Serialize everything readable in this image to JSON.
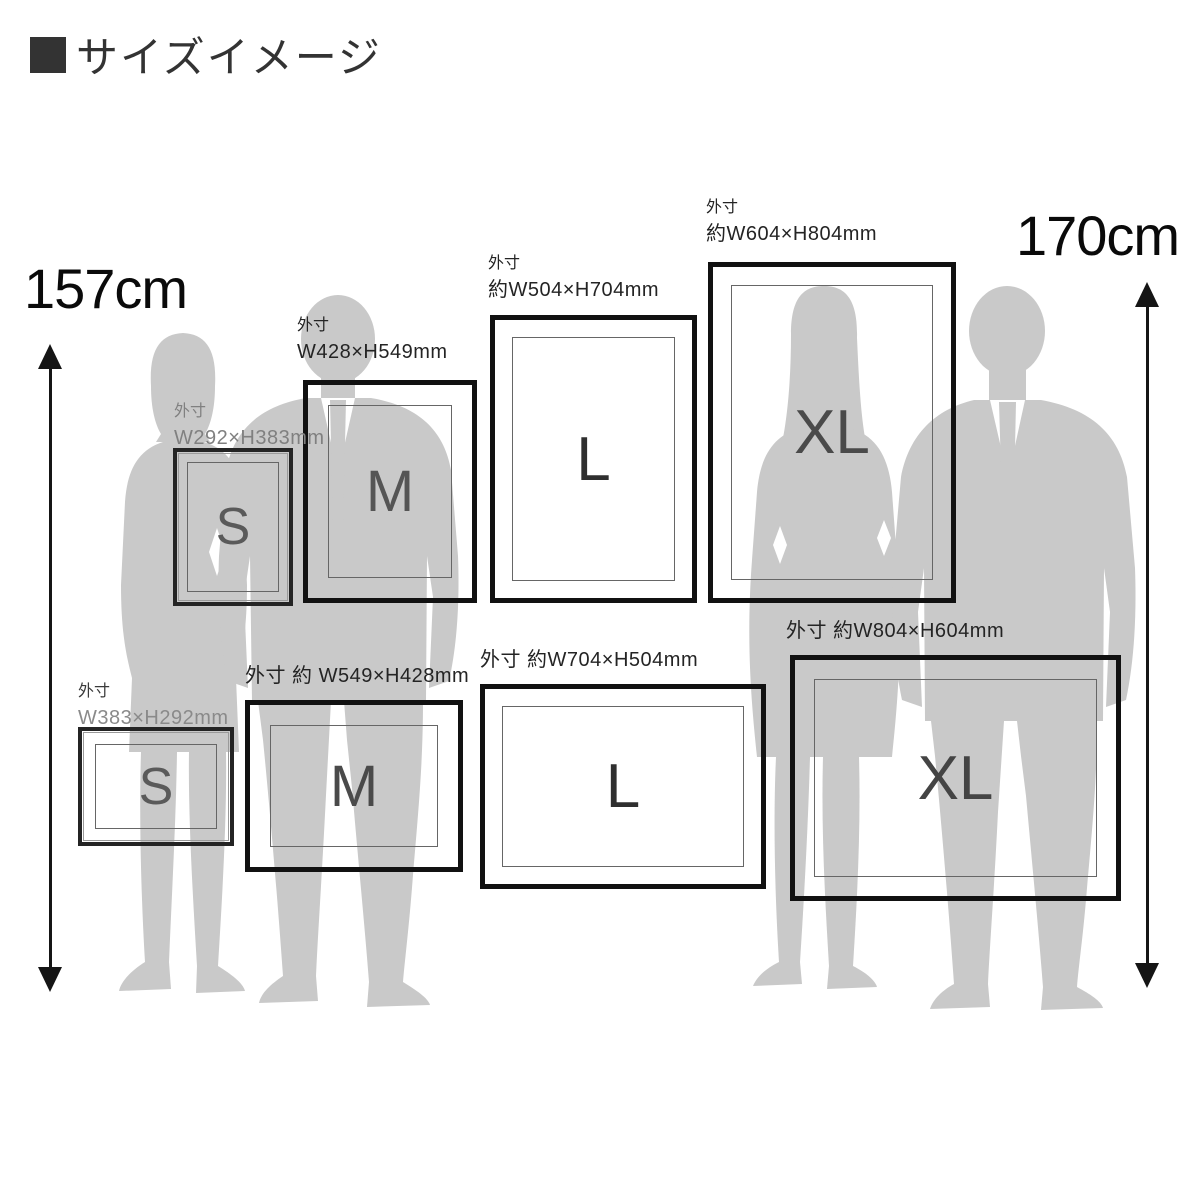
{
  "title": {
    "bullet": "■",
    "text": "サイズイメージ"
  },
  "measurements": {
    "left_height": "157cm",
    "right_height": "170cm"
  },
  "frames": {
    "portrait": [
      {
        "size": "S",
        "l1": "外寸",
        "l2": "W292×H383mm"
      },
      {
        "size": "M",
        "l1": "外寸",
        "l2": "W428×H549mm"
      },
      {
        "size": "L",
        "l1": "外寸",
        "l2": "約W504×H704mm"
      },
      {
        "size": "XL",
        "l1": "外寸",
        "l2": "約W604×H804mm"
      }
    ],
    "landscape": [
      {
        "size": "S",
        "l1": "外寸",
        "l2": "W383×H292mm"
      },
      {
        "size": "M",
        "l1": "外寸 約 W549×H428mm"
      },
      {
        "size": "L",
        "l1": "外寸 約W704×H504mm"
      },
      {
        "size": "XL",
        "l1": "外寸 約W804×H604mm"
      }
    ]
  },
  "people": [
    {
      "id": "woman-left",
      "height_label": "157cm"
    },
    {
      "id": "man-left",
      "height_label": ""
    },
    {
      "id": "woman-right",
      "height_label": ""
    },
    {
      "id": "man-right",
      "height_label": "170cm"
    }
  ],
  "colors": {
    "silhouette": "#c9c9c9",
    "frame_border": "#111111",
    "size_letter": "#4f4f4f",
    "label_gray": "#808080",
    "label_dark": "#242424",
    "arrow": "#151515"
  }
}
